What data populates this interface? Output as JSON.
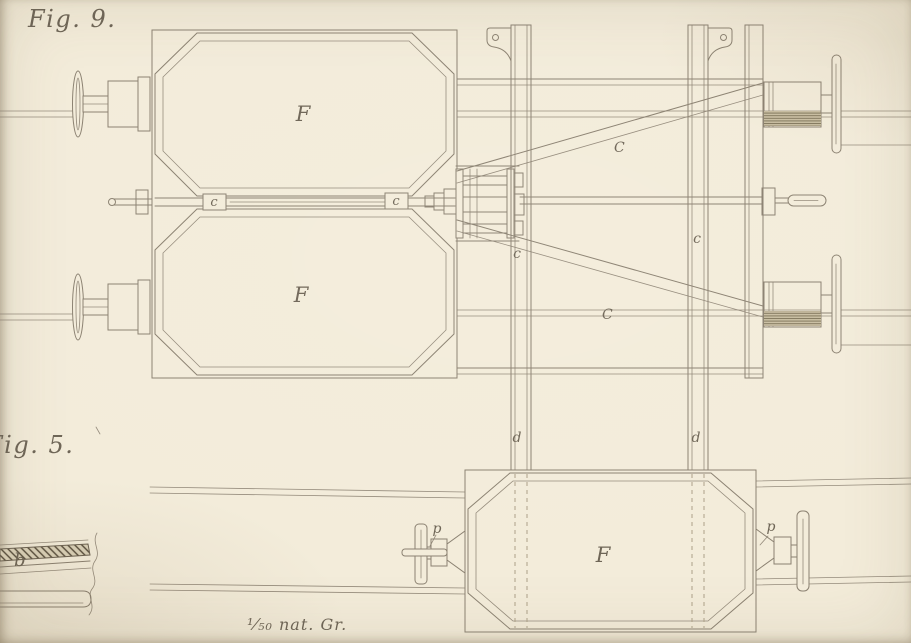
{
  "plate": {
    "fig9_label": "Fig. 9.",
    "fig5_label": "Fig. 5.",
    "scale_note": "¹⁄₅₀ nat. Gr."
  },
  "labels": {
    "frame_top_f": "F",
    "frame_bottom_f": "F",
    "wagon_f": "F",
    "rod_c_left": "c",
    "rod_c_right": "c",
    "beam_c_left": "c",
    "beam_c_right": "c",
    "brace_c_upper": "C",
    "brace_c_lower": "C",
    "post_d_left": "d",
    "post_d_right": "d",
    "buffer_p_left": "p",
    "buffer_p_right": "p",
    "section_b": "b"
  },
  "colors": {
    "paper": "#f3ecda",
    "ink": "#8a8070",
    "ink_dark": "#6b6151",
    "ink_faint": "#ab9f87",
    "label": "#6d6455"
  }
}
